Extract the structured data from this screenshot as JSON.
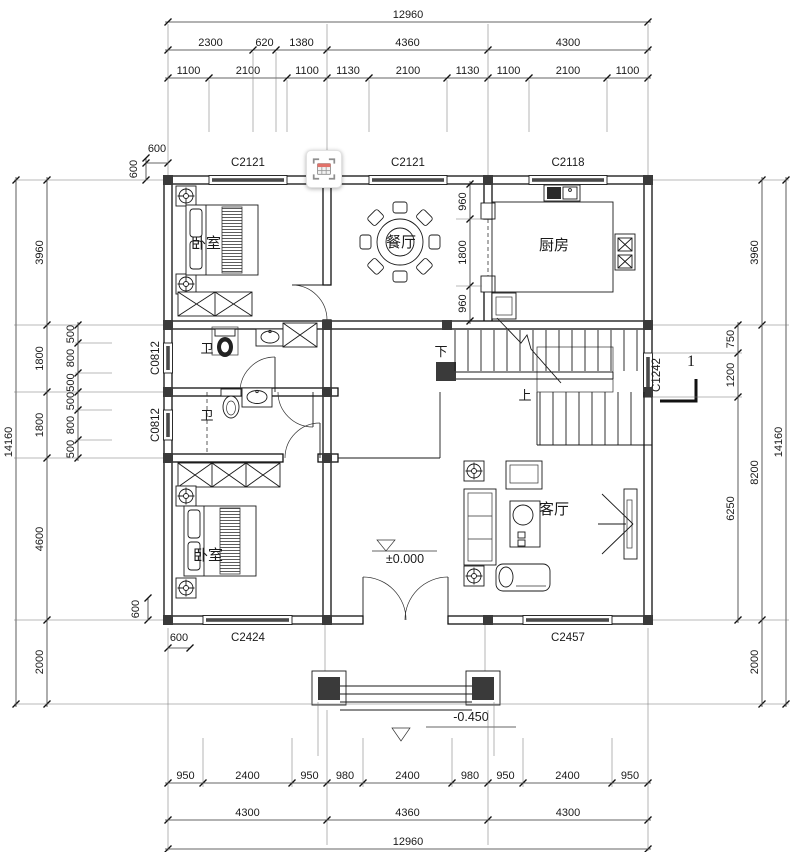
{
  "plan": {
    "rooms": {
      "bedroom_top": "卧室",
      "bedroom_bottom": "卧室",
      "dining": "餐厅",
      "kitchen": "厨房",
      "living": "客厅",
      "bath_top": "卫",
      "bath_bottom": "卫"
    },
    "stairs": {
      "down": "下",
      "up": "上"
    },
    "levels": {
      "main": "±0.000",
      "porch": "-0.450"
    },
    "section_mark": "1",
    "windows": {
      "top_left": "C2121",
      "top_mid": "C2121",
      "top_right": "C2118",
      "left_upper": "C0812",
      "left_lower": "C0812",
      "right_mid": "C1242",
      "bottom_left": "C2424",
      "bottom_right": "C2457"
    }
  },
  "dims": {
    "top_total": "12960",
    "top_row2": [
      "2300",
      "620",
      "1380",
      "4360",
      "4300"
    ],
    "top_row3": [
      "1100",
      "2100",
      "1100",
      "1130",
      "2100",
      "1130",
      "1100",
      "2100",
      "1100"
    ],
    "bottom_row1": [
      "950",
      "2400",
      "950",
      "980",
      "2400",
      "980",
      "950",
      "2400",
      "950"
    ],
    "bottom_row2": [
      "4300",
      "4360",
      "4300"
    ],
    "bottom_total": "12960",
    "left_outer": "14160",
    "left_col": [
      "3960",
      "1800",
      "1800",
      "4600",
      "2000"
    ],
    "left_sub": [
      "500",
      "800",
      "500",
      "500",
      "800",
      "500"
    ],
    "right_inner": [
      "750",
      "1200",
      "6250"
    ],
    "right_col": [
      "3960",
      "8200",
      "2000"
    ],
    "right_outer": "14160",
    "dining_col": [
      "960",
      "1800",
      "960"
    ],
    "c600": [
      "600",
      "600",
      "600",
      "600"
    ]
  },
  "colors": {
    "line": "#1a1a1a",
    "column_fill": "#3a3a3a",
    "window_bar": "#4a4a4a",
    "overlay_header": "#e2726a"
  }
}
